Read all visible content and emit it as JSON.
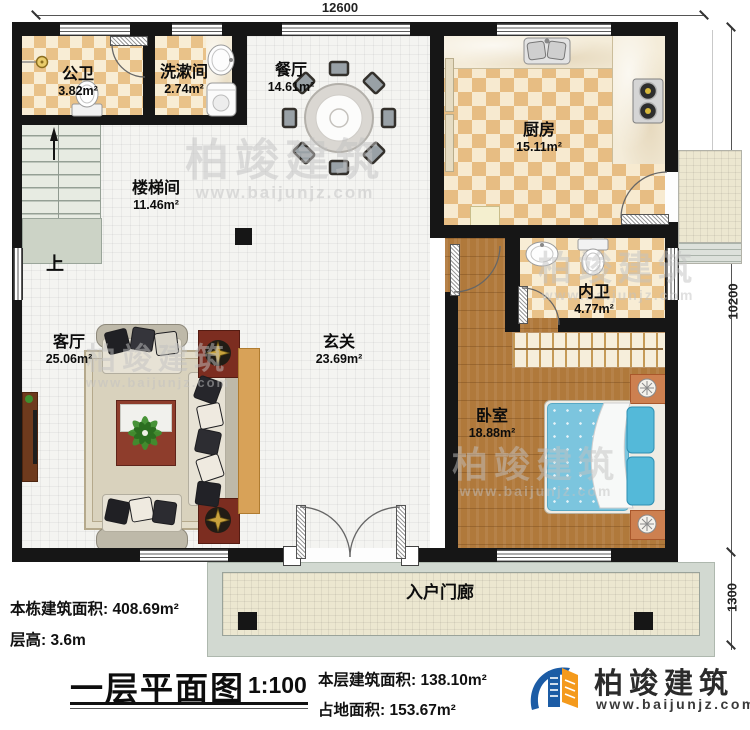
{
  "plan": {
    "dimensions": {
      "width_top": "12600",
      "height_right": "10200",
      "porch_depth": "1300"
    },
    "rooms": [
      {
        "name": "公卫",
        "area": "3.82m²"
      },
      {
        "name": "洗漱间",
        "area": "2.74m²"
      },
      {
        "name": "餐厅",
        "area": "14.61m²"
      },
      {
        "name": "厨房",
        "area": "15.11m²"
      },
      {
        "name": "楼梯间",
        "area": "11.46m²"
      },
      {
        "name": "内卫",
        "area": "4.77m²"
      },
      {
        "name": "客厅",
        "area": "25.06m²"
      },
      {
        "name": "玄关",
        "area": "23.69m²"
      },
      {
        "name": "卧室",
        "area": "18.88m²"
      },
      {
        "name": "入户门廊",
        "area": ""
      }
    ],
    "stair_direction_label": "上"
  },
  "footer": {
    "building_area_label": "本栋建筑面积:",
    "building_area_value": "408.69m²",
    "floor_height_label": "层高:",
    "floor_height_value": "3.6m",
    "title": "一层平面图",
    "scale": "1:100",
    "floor_area_label": "本层建筑面积:",
    "floor_area_value": "138.10m²",
    "footprint_label": "占地面积:",
    "footprint_value": "153.67m²"
  },
  "logo": {
    "name": "柏竣建筑",
    "website": "www.baijunjz.com"
  },
  "watermark": {
    "name": "柏竣建筑",
    "website": "www.baijunjz.com"
  },
  "colors": {
    "wall": "#161616",
    "checker_tan": "#e9c289",
    "wood_floor": "#b0793b",
    "bed_blue": "#7cc5de",
    "logo_blue": "#1c5ca5",
    "logo_orange": "#f49a1c"
  }
}
